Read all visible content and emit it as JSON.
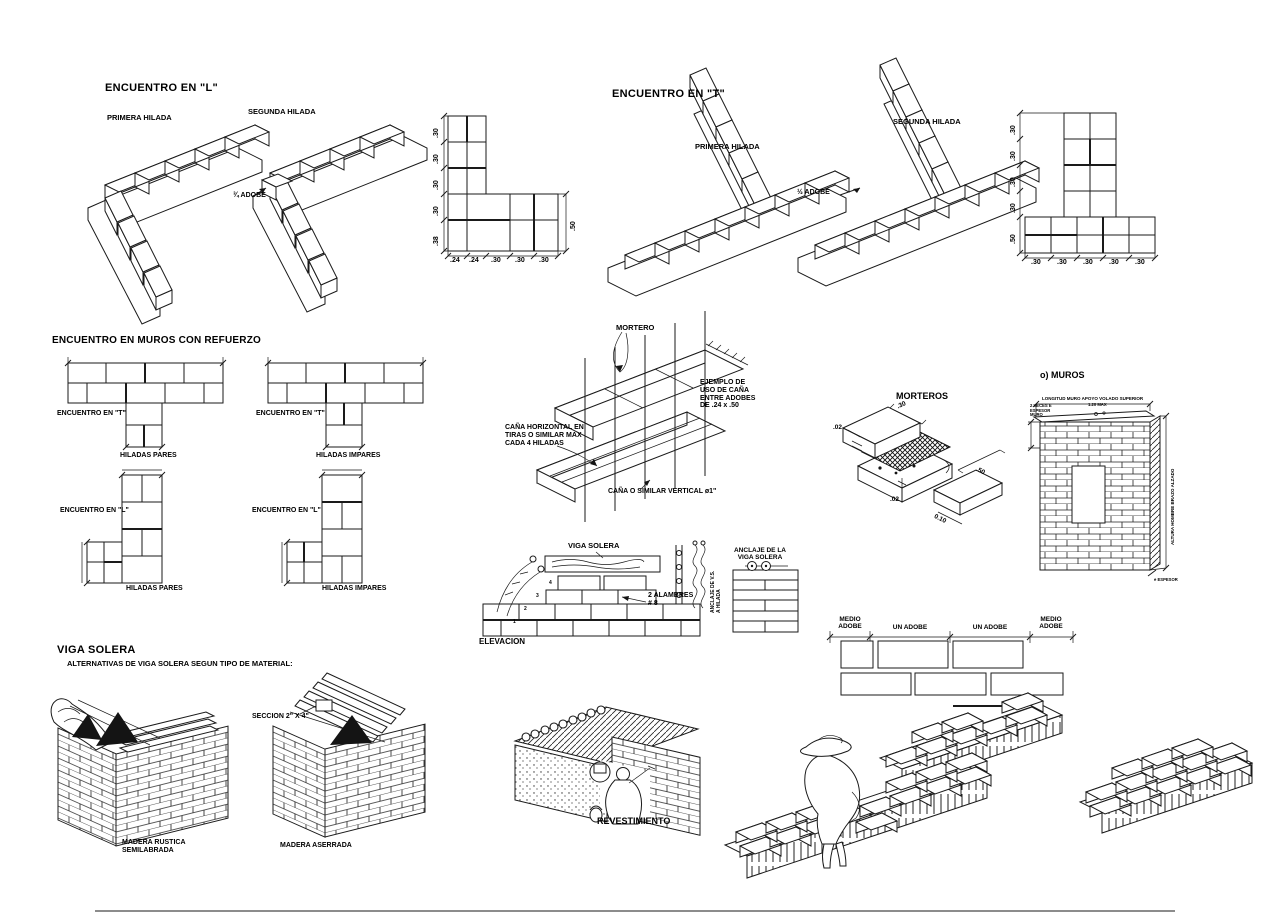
{
  "encuentro_l": {
    "title": "ENCUENTRO EN \"L\"",
    "primera_hilada": "PRIMERA HILADA",
    "segunda_hilada": "SEGUNDA HILADA",
    "adobe_note": "¾ ADOBE",
    "plan_v_dims": [
      ".30",
      ".30",
      ".30",
      ".30",
      ".38"
    ],
    "plan_h_dims": [
      ".24",
      ".24",
      ".30",
      ".30",
      ".30"
    ],
    "plan_side_dim": ".50"
  },
  "encuentro_t": {
    "title": "ENCUENTRO EN \"T\"",
    "primera_hilada": "PRIMERA HILADA",
    "segunda_hilada": "SEGUNDA HILADA",
    "adobe_note": "½ ADOBE",
    "plan_v_dims": [
      ".30",
      ".30",
      ".30",
      ".30",
      ".50"
    ],
    "plan_h_dims": [
      ".30",
      ".30",
      ".30",
      ".30",
      ".30"
    ]
  },
  "muros_refuerzo": {
    "title": "ENCUENTRO EN MUROS CON REFUERZO",
    "t_pares_label": "ENCUENTRO EN \"T\"",
    "t_pares_sub": "HILADAS PARES",
    "t_impares_label": "ENCUENTRO EN \"T\"",
    "t_impares_sub": "HILADAS IMPARES",
    "l_pares_label": "ENCUENTRO EN \"L\"",
    "l_pares_sub": "HILADAS PARES",
    "l_impares_label": "ENCUENTRO EN \"L\"",
    "l_impares_sub": "HILADAS IMPARES"
  },
  "cana": {
    "mortero_label": "MORTERO",
    "ejemplo_note": "EJEMPLO DE\nUSO DE CAÑA\nENTRE ADOBES\nDE .24 x .50",
    "horizontal_note": "CAÑA HORIZONTAL EN\nTIRAS O SIMILAR MAX\nCADA 4 HILADAS",
    "vertical_note": "CAÑA O SIMILAR VERTICAL ø1\""
  },
  "morteros": {
    "title": "MORTEROS",
    "dim_top": ".02",
    "dim_bottom": ".02",
    "dim_width": ".30",
    "dim_length": ".50",
    "dim_height": "0.10"
  },
  "muros": {
    "title": "o) MUROS",
    "top_note": "LONGITUD MURO APOYO VOLADO SUPERIOR",
    "left_note": "2 VECES E\nESPESOR\nMURO",
    "mid_note": "1.20 MAX",
    "height_note": "ALTURA HOMBRE BRAZO ALZADO",
    "thickness_note": "e ESPESOR"
  },
  "viga_elev": {
    "viga_label": "VIGA SOLERA",
    "alambres_note": "2 ALAMBRES\n# 8",
    "elevacion_label": "ELEVACION",
    "anclaje_title": "ANCLAJE DE LA\nVIGA SOLERA",
    "anclaje_side": "ANCLAJE DE V.S.\nA HILADA",
    "step_numbers": [
      "4",
      "3",
      "2",
      "1"
    ]
  },
  "viga_solera": {
    "title": "VIGA SOLERA",
    "subtitle": "ALTERNATIVAS DE VIGA SOLERA SEGUN TIPO DE MATERIAL:",
    "seccion_note": "SECCION 2\" X 4\"",
    "madera_rustica": "MADERA RUSTICA\nSEMILABRADA",
    "madera_aserrada": "MADERA ASERRADA"
  },
  "revestimiento": {
    "title": "REVESTIMIENTO"
  },
  "aparejo": {
    "medio_1": "MEDIO\nADOBE",
    "un_1": "UN ADOBE",
    "un_2": "UN ADOBE",
    "medio_2": "MEDIO\nADOBE"
  }
}
